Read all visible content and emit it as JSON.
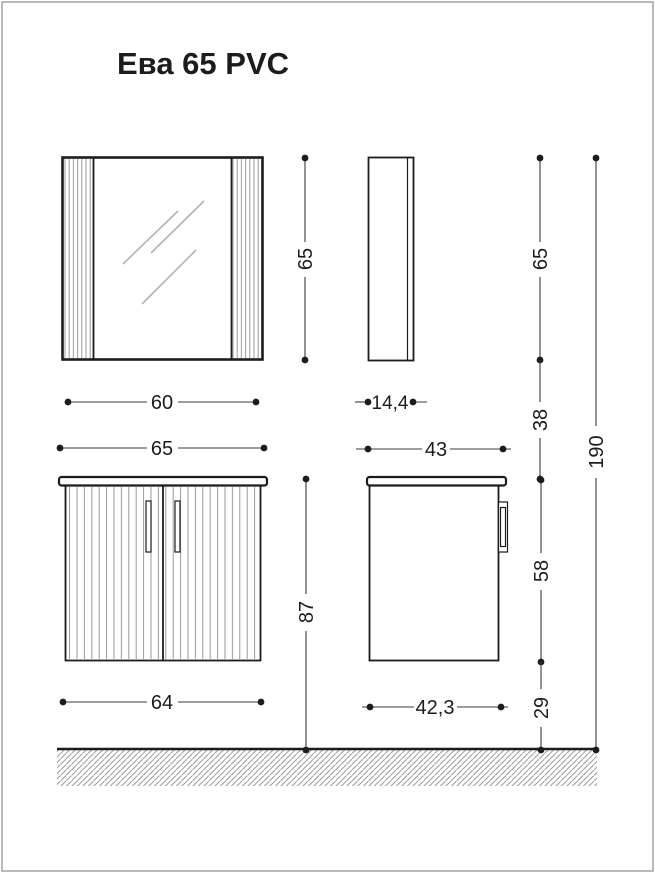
{
  "title": "Ева 65 PVC",
  "dims": {
    "mirror_width": "60",
    "mirror_height": "65",
    "mirror_depth": "14,4",
    "cabinet_width": "65",
    "cabinet_depth": "43",
    "cabinet_height": "87",
    "body_width": "64",
    "body_depth": "42,3",
    "wall_mirror_height": "65",
    "gap_mirror_cabinet": "38",
    "body_height": "58",
    "floor_clearance": "29",
    "total_height": "190"
  },
  "colors": {
    "ink": "#1c1c1c",
    "dimline": "#3a3a3a",
    "flute": "#9a9a9a",
    "hatch": "#9a9a9a",
    "glint": "#b3b3b3",
    "border": "#8c8c8c",
    "bg": "#ffffff"
  }
}
